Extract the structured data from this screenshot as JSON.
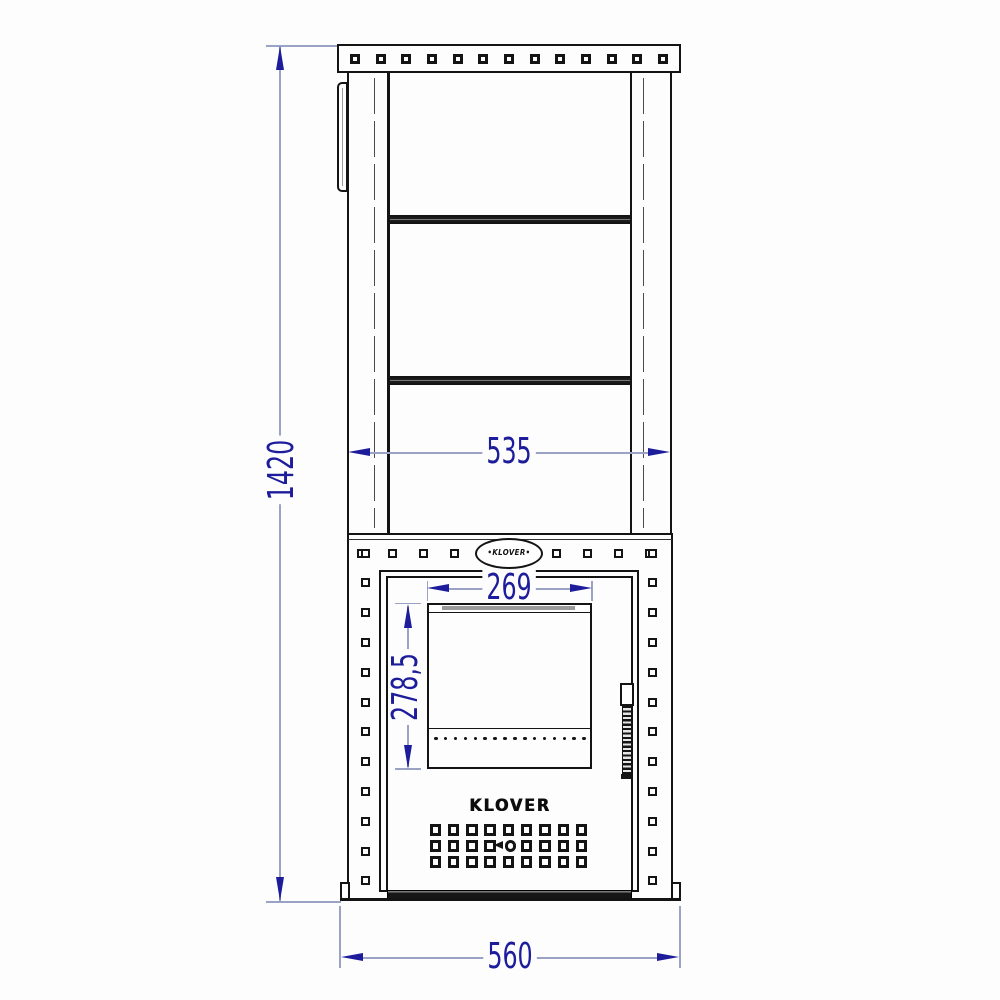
{
  "drawing": {
    "title": "Wood stove front view technical drawing",
    "brand": "KLOVER",
    "badge_text": "•KLOVER•",
    "dimensions": {
      "overall_height": {
        "value": "1420",
        "unit": "mm",
        "orientation": "vertical",
        "measures": "overall stove height"
      },
      "chimney_shaft_width": {
        "value": "535",
        "unit": "mm",
        "orientation": "horizontal",
        "measures": "upper shaft outer width"
      },
      "door_glass_width": {
        "value": "269",
        "unit": "mm",
        "orientation": "horizontal",
        "measures": "door window width"
      },
      "door_glass_height": {
        "value": "278,5",
        "unit": "mm",
        "orientation": "vertical",
        "measures": "door window height"
      },
      "body_width": {
        "value": "560",
        "unit": "mm",
        "orientation": "horizontal",
        "measures": "stove base overall width"
      }
    },
    "colors": {
      "line": "#141414",
      "dim_line": "#9aa2c6",
      "dim_text": "#1d1d9c",
      "background": "#fdfdfd"
    },
    "structure": {
      "flange_hole_count": 13,
      "body_top_holes_per_side": 4,
      "body_side_hole_count": 12,
      "glass_vent_dot_count": 16,
      "crossbar_count": 2,
      "vent_grid_rows": 3,
      "vent_grid_cols": 9,
      "vent_grid_keyhole": {
        "row": 2,
        "col": 5
      }
    }
  }
}
